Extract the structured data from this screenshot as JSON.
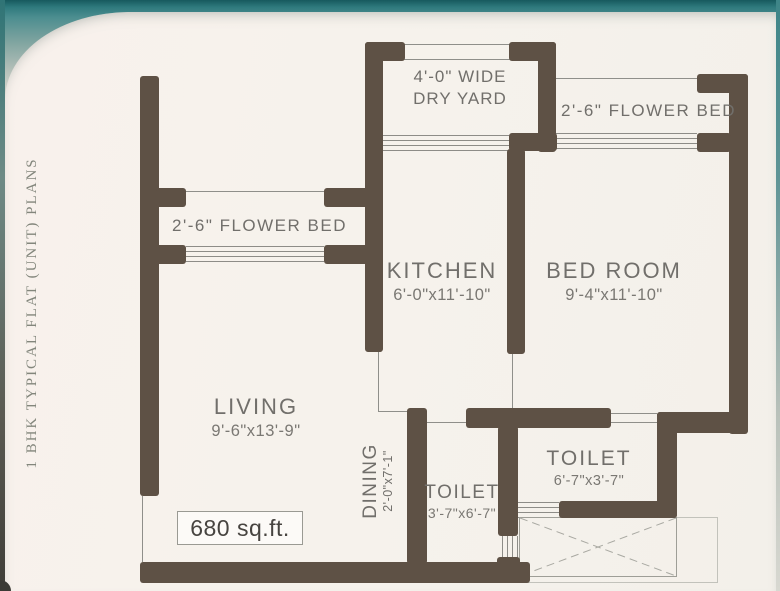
{
  "side_title": "1 BHK TYPICAL FLAT (UNIT) PLANS",
  "rooms": {
    "dry_yard": {
      "line1": "4'-0\" WIDE",
      "line2": "DRY YARD"
    },
    "flower_bed_top": {
      "label": "2'-6\" FLOWER BED"
    },
    "flower_bed_left": {
      "label": "2'-6\" FLOWER BED"
    },
    "kitchen": {
      "name": "KITCHEN",
      "dims": "6'-0\"x11'-10\""
    },
    "bed_room": {
      "name": "BED ROOM",
      "dims": "9'-4\"x11'-10\""
    },
    "living": {
      "name": "LIVING",
      "dims": "9'-6\"x13'-9\""
    },
    "dining": {
      "name": "DINING",
      "dims": "2'-0\"x7'-1\""
    },
    "toilet_main": {
      "name": "TOILET",
      "dims": "6'-7\"x3'-7\""
    },
    "toilet_small": {
      "name": "TOILET",
      "dims": "3'-7\"x6'-7\""
    }
  },
  "area": {
    "label": "680 sq.ft."
  },
  "colors": {
    "wall": "#5e5145",
    "teal_band": "#3e8588",
    "page_bg": "#f6f2ec",
    "label_gray": "#716f6b"
  }
}
